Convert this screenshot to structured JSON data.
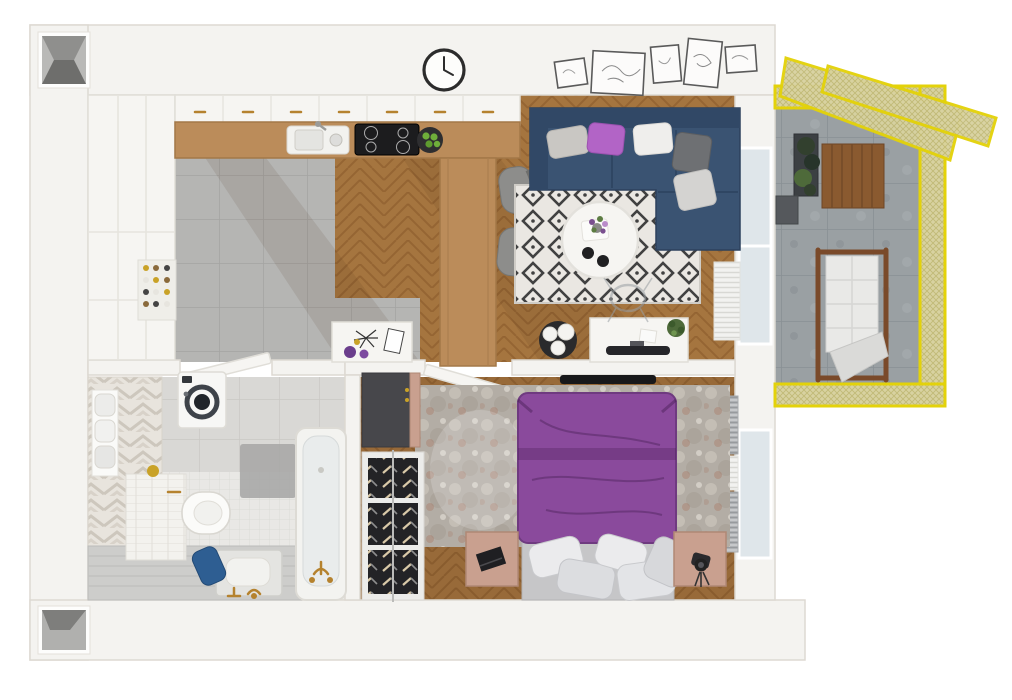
{
  "meta": {
    "description": "3D rendered top-down floor plan of a one-bedroom apartment with a yellow-screened balcony",
    "view": "top-down",
    "width_px": 1012,
    "height_px": 700
  },
  "palette": {
    "wall": "#f4f3f0",
    "wallLine": "#ddd9d2",
    "shaft": "#8a8a88",
    "wood": "#a5753f",
    "woodLine": "#8c5c2d",
    "tile": "#b5b5b3",
    "tileLine": "#a4a4a2",
    "mosaic": "#e9e8e5",
    "mosaicLine": "#dcdbd7",
    "bigTile": "#d9d8d5",
    "bigTileLine": "#c9c8c4",
    "chevA": "#e8e4dd",
    "chevB": "#cdc7bd",
    "concrete": "#9aa0a3",
    "concreteLine": "#899094",
    "fenceYellow": "#e3d20a",
    "mesh": "#d8d2a0",
    "meshLine": "#c1ba77",
    "sofa": "#3a5372",
    "sofaDark": "#314866",
    "cushGray": "#c9c7c3",
    "cushPurple": "#b264c6",
    "cushWhite": "#efeeec",
    "cushGraphite": "#6e7073",
    "cushLight": "#d4d3d1",
    "rugBg": "#eae7e2",
    "rugInk": "#414141",
    "bedPurple": "#8a4a9c",
    "bedPurpleDark": "#6f3a80",
    "mottleA": "#b3ada5",
    "mottleB": "#c4beb5",
    "mottleRust": "#a5705c",
    "nightstand": "#c9a08f",
    "nightstandLine": "#b08875",
    "wardrobe": "#47474b",
    "rackDark": "#232326",
    "rackFrame": "#ececea",
    "whiteFurn": "#f6f5f2",
    "furnLine": "#e0ded8",
    "counterWood": "#bb8c5a",
    "hob": "#1c1c1e",
    "dark": "#18181a",
    "chair": "#8d8d8b",
    "brass": "#b5822e",
    "gold": "#c9a227",
    "radiator": "#c6c8ca",
    "radiatorLine": "#979a9d",
    "curtain": "#f2f2f0",
    "curtainLine": "#d8d8d4",
    "glass": "#dfe6ea",
    "plantDark": "#32402e",
    "plantMid": "#4e6a3a",
    "apple": "#6fae3a",
    "deckWood": "#8a5a30",
    "towelBlue": "#2e5e92",
    "washerRing": "#3e434a",
    "shadow": "rgba(70,42,18,0.10)"
  },
  "rooms": [
    {
      "name": "kitchen",
      "floor": "gray-ceramic-tile",
      "items": [
        "tall-cabinet-column",
        "pantry-shelf-with-jars",
        "upper-cabinet-run",
        "wood-countertop",
        "sink",
        "induction-hob",
        "l-shaped-breakfast-bar",
        "fruit-bowl-with-apples",
        "bar-stool",
        "bar-stool",
        "wall-clock"
      ]
    },
    {
      "name": "living-dining",
      "floor": "herringbone-oak",
      "items": [
        "navy-corner-sofa",
        "cushion-gray",
        "cushion-purple",
        "cushion-white",
        "cushion-graphite",
        "cushion-light-gray",
        "diamond-pattern-rug",
        "round-coffee-table",
        "flower-vase",
        "espresso-cups",
        "black-side-table-with-sphere-lamps",
        "work-desk",
        "monitor",
        "desk-plant",
        "ghost-chair",
        "console-sideboard",
        "picture-frame",
        "picture-frame",
        "picture-frame",
        "picture-frame",
        "picture-frame",
        "curtains",
        "radiator"
      ]
    },
    {
      "name": "bedroom",
      "floor": "herringbone-oak",
      "items": [
        "double-bed-purple-duvet",
        "white-pillows",
        "mottled-area-rug",
        "nightstand-with-laptop",
        "nightstand-with-camera",
        "dark-wardrobe-cabinet",
        "open-shoe-rack",
        "wall-mounted-tv",
        "radiator",
        "radiator",
        "curtain"
      ]
    },
    {
      "name": "bathroom",
      "floor": "white-mosaic-tile",
      "items": [
        "chevron-tiled-wall",
        "washing-machine",
        "towel-niche",
        "wall-hung-toilet-on-tiled-block",
        "gold-cup",
        "stone-bidet-basin",
        "brass-floor-faucet",
        "bathtub",
        "brass-bath-taps",
        "tiled-bench",
        "bath-mat",
        "blue-towel"
      ]
    },
    {
      "name": "hallway",
      "floor": "gray-ceramic-tile",
      "items": [
        "white-sideboard",
        "decor-frame",
        "purple-spheres",
        "open-door-to-bathroom",
        "open-door-to-bedroom"
      ]
    },
    {
      "name": "balcony",
      "floor": "concrete-tile",
      "items": [
        "yellow-mesh-privacy-screens",
        "yellow-mesh-fence",
        "wood-lounge-chair-with-cushion",
        "planter-with-plants",
        "wood-deck-table",
        "storage-box"
      ]
    }
  ],
  "architecture": [
    "exterior-walls",
    "duct-shaft-top-left",
    "duct-shaft-bottom-left",
    "glass-door-to-balcony",
    "bedroom-window"
  ]
}
